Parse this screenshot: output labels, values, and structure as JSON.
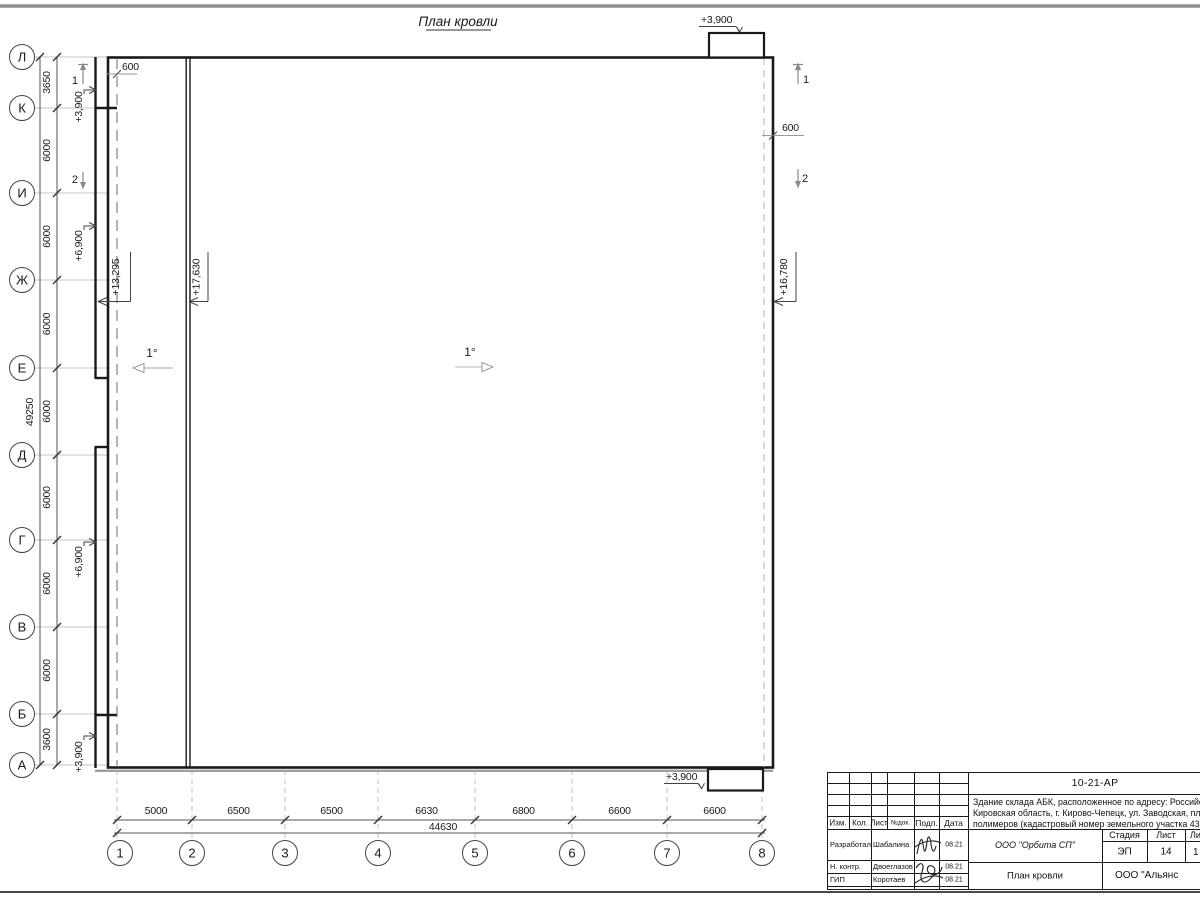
{
  "sheet": {
    "title": "План кровли"
  },
  "plan": {
    "row_axes": [
      "Л",
      "К",
      "И",
      "Ж",
      "Е",
      "Д",
      "Г",
      "В",
      "Б",
      "А"
    ],
    "row_dims": [
      "3650",
      "6000",
      "6000",
      "6000",
      "6000",
      "6000",
      "6000",
      "6000",
      "3600"
    ],
    "row_total": "49250",
    "col_axes": [
      "1",
      "2",
      "3",
      "4",
      "5",
      "6",
      "7",
      "8"
    ],
    "col_dims": [
      "5000",
      "6500",
      "6500",
      "6630",
      "6800",
      "6600",
      "6600"
    ],
    "col_total": "44630",
    "slope_left": "1°",
    "slope_center": "1°",
    "offset_left": "600",
    "offset_right": "600",
    "elev_canopy_top": "+3,900",
    "elev_canopy_bottom": "+3,900",
    "elev_wall_k": "+3,900",
    "elev_wall_zh": "+6,900",
    "elev_wall_g": "+6,900",
    "elev_wall_a": "+3,900",
    "elev_roof_low": "+13,295",
    "elev_roof_high": "+17,630",
    "elev_roof_right": "+16,780",
    "section_1": "1",
    "section_2": "2"
  },
  "title_block": {
    "code": "10-21-АР",
    "description_line1": "Здание склада АБК, расположенное по адресу: Российская Феде",
    "description_line2": "Кировская область, г. Кирово-Чепецк, ул. Заводская, площадка з",
    "description_line3": "полимеров (кадастровый номер земельного участка 43:42:00000",
    "header": {
      "izm": "Изм.",
      "kol": "Кол.",
      "list": "Лист",
      "ndok": "№док.",
      "podp": "Подп.",
      "data": "Дата"
    },
    "rows": [
      {
        "role": "Разработал",
        "name": "Шабалина",
        "date": "08.21"
      },
      {
        "role": "Н. контр.",
        "name": "Двоеглазов",
        "date": "08.21"
      },
      {
        "role": "ГИП",
        "name": "Коротаев",
        "date": "08.21"
      }
    ],
    "company": "ООО \"Орбита СП\"",
    "stage_label": "Стадия",
    "sheet_label": "Лист",
    "sheets_label": "Ли",
    "stage": "ЭП",
    "sheet_no": "14",
    "sheets_no": "1",
    "drawing_title": "План кровли",
    "contractor": "ООО \"Альянс"
  }
}
